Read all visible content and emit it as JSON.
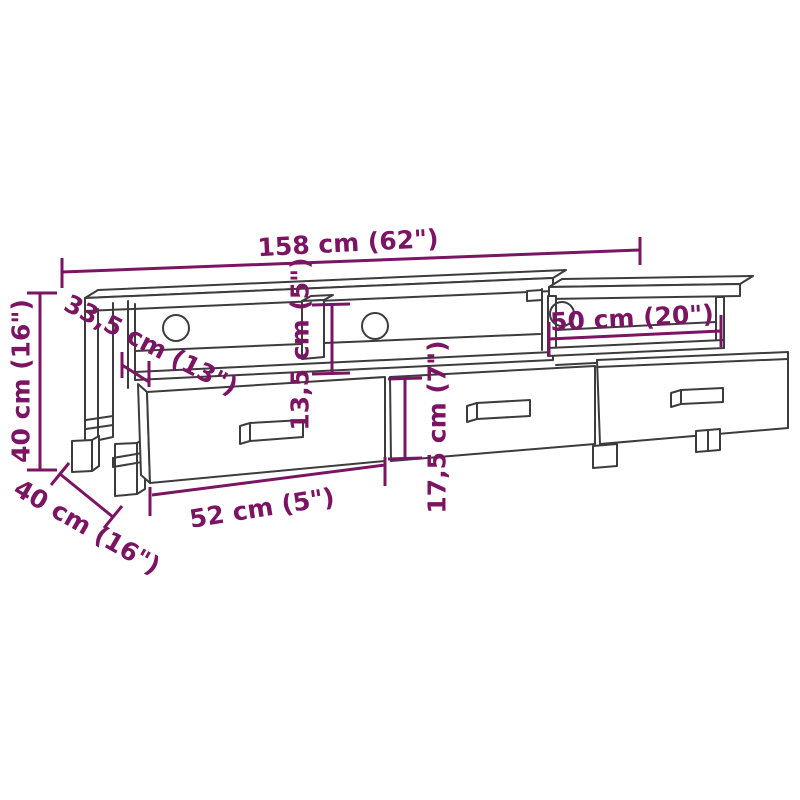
{
  "diagram": {
    "colors": {
      "dimension_color": "#7B1463",
      "outline_color": "#3C3C3E",
      "background": "#FFFFFF"
    },
    "dims": {
      "total_width": "158 cm (62\")",
      "height": "40 cm (16\")",
      "top_depth": "33,5 cm (13\")",
      "shelf_opening_height": "13,5 cm (5\")",
      "right_compartment_width": "50 cm (20\")",
      "drawer_front_height": "17,5 cm (7\")",
      "drawer_width": "52 cm (5\")",
      "base_depth": "40 cm (16\")"
    }
  }
}
